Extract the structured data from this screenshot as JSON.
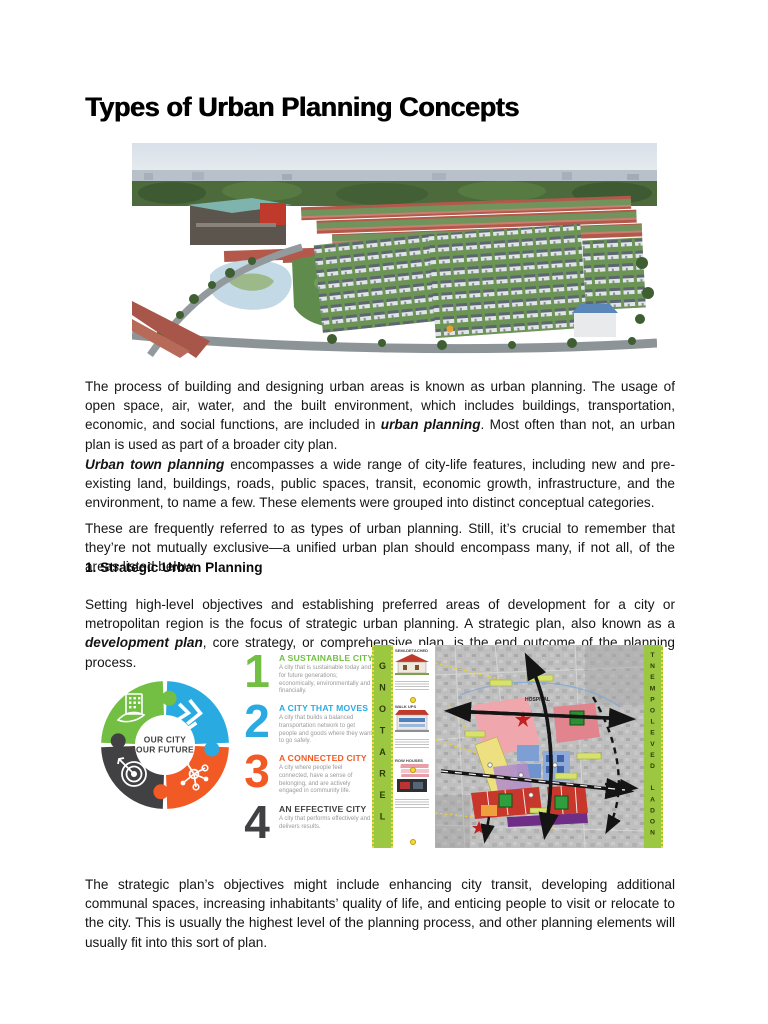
{
  "page": {
    "title": "Types of Urban Planning Concepts"
  },
  "hero_image": {
    "alt_name": "aerial-render-of-housing-development"
  },
  "paragraphs": {
    "p1_pre": "The process of building and designing urban areas is known as urban planning. The usage of open space, air, water, and the built environment, which includes buildings, transportation, economic, and social functions, are included in ",
    "p1_bold": "urban planning",
    "p1_post": ". Most often than not, an urban plan is used as part of a broader city plan.",
    "p2_bold": "Urban town planning",
    "p2_post": " encompasses a wide range of city-life features, including new and pre-existing land, buildings, roads, public spaces, transit, economic growth, infrastructure, and the environment, to name a few. These elements were grouped into distinct conceptual categories.",
    "p3": "These are frequently referred to as types of urban planning. Still, it’s crucial to remember that they’re not mutually exclusive—a unified urban plan should encompass many, if not all, of the areas listed below.",
    "section1_heading": "1. Strategic Urban Planning",
    "p4_pre": "Setting high-level objectives and establishing preferred areas of development for a city or metropolitan region is the focus of strategic urban planning.  A strategic plan, also known as a ",
    "p4_bold": "development plan",
    "p4_post": ", core strategy, or comprehensive plan, is the end outcome of the planning process.",
    "p5": "The strategic plan’s objectives might include enhancing city transit, developing additional communal spaces, increasing inhabitants’ quality of life, and enticing people to visit or relocate to the city. This is usually the highest level of the planning process, and other planning elements will usually fit into this sort of plan."
  },
  "infographic": {
    "center_line1": "OUR CITY",
    "center_line2": "OUR FUTURE",
    "items": [
      {
        "num": "1",
        "title": "A SUSTAINABLE CITY",
        "desc": "A city that is sustainable today and for future generations; economically, environmentally and financially.",
        "color": "#72BF44"
      },
      {
        "num": "2",
        "title": "A CITY THAT MOVES",
        "desc": "A city that builds a balanced transportation network to get people and goods where they want to go safely.",
        "color": "#29ABE2"
      },
      {
        "num": "3",
        "title": "A CONNECTED CITY",
        "desc": "A city where people feel connected, have a sense of belonging, and are actively engaged in community life.",
        "color": "#F15A24"
      },
      {
        "num": "4",
        "title": "AN EFFECTIVE CITY",
        "desc": "A city that performs effectively and delivers results.",
        "color": "#414042"
      }
    ],
    "colors": {
      "green": "#72BF44",
      "blue": "#29ABE2",
      "orange": "#F15A24",
      "dark": "#414042"
    }
  },
  "map_infographic": {
    "left_banner": "LERATONG",
    "right_banner": "NODAL DEVELOPMENT",
    "hospital_label": "HOSPITAL",
    "housing_labels": [
      "SEMI-DETACHED",
      "WALK UPS",
      "ROW HOUSES"
    ],
    "banner_color": "#9CC841"
  }
}
